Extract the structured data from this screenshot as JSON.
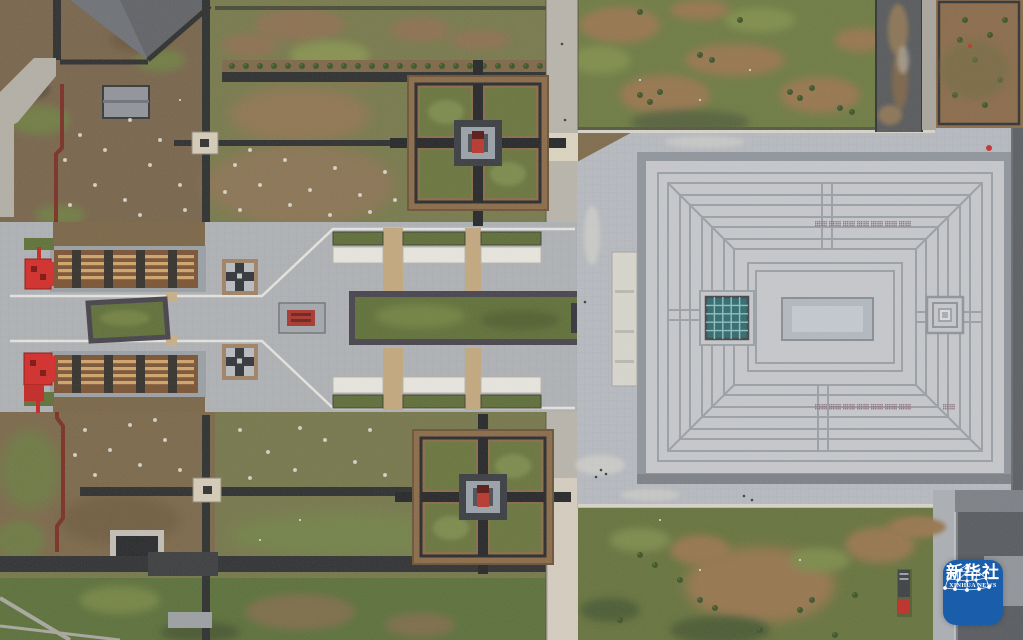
{
  "image": {
    "kind": "aerial-drone-photograph",
    "subject": "Top-down view of a memorial park complex: a huge square-roofed hall with concentric roof rings on the right, a ceremonial axis with excavation pits, wooden walkways, white canopy shelters and red gates on the left, two cross-shaped courtyard gardens, lawns, bare-earth fields and tree-lined dark paths",
    "width_px": 1023,
    "height_px": 640
  },
  "watermark": {
    "agency_cn": "新华社",
    "agency_en": "XINHUA NEWS",
    "icon": "network-dome-icon",
    "badge_color": "#1a5dab",
    "text_color": "#ffffff"
  },
  "palette": {
    "earth_brown": "#7e6a4b",
    "lawn_green": "#67743d",
    "olive_field": "#76784a",
    "shrub_green": "#3c5226",
    "path_dark": "#2b2d2e",
    "plaza_gray": "#b7bac1",
    "roof_gray": "#c7c8cc",
    "roof_frame_gray": "#8f949c",
    "roof_line_gray": "#9aa0a6",
    "skylight_teal": "#2e6a6e",
    "gate_red": "#d42a28",
    "pavilion_red": "#b42d26",
    "wall_maroon": "#7a2a22",
    "wood_brown": "#7a5233",
    "wood_stripe_tan": "#d2a469",
    "pit_green": "#5e6f37",
    "road_dark_gray": "#5a5d62",
    "concrete_light": "#d8d6ce",
    "truck_red": "#bf2b25"
  },
  "scene_features": [
    "main-hall-square-roof",
    "roof-teal-skylight-grid",
    "roof-central-courtyard",
    "roof-vent-grids",
    "surrounding-plaza",
    "north-cross-courtyard-garden",
    "south-cross-courtyard-garden",
    "central-excavation-pit",
    "small-excavation-pit",
    "red-gate-structures",
    "wooden-walkways",
    "white-canopy-shelters",
    "red-relic-display",
    "small-cross-pavilions",
    "tree-lined-paths",
    "lawns-and-bare-earth-fields",
    "perimeter-roads",
    "red-truck",
    "dark-pitched-roof-building",
    "maroon-boundary-wall"
  ]
}
